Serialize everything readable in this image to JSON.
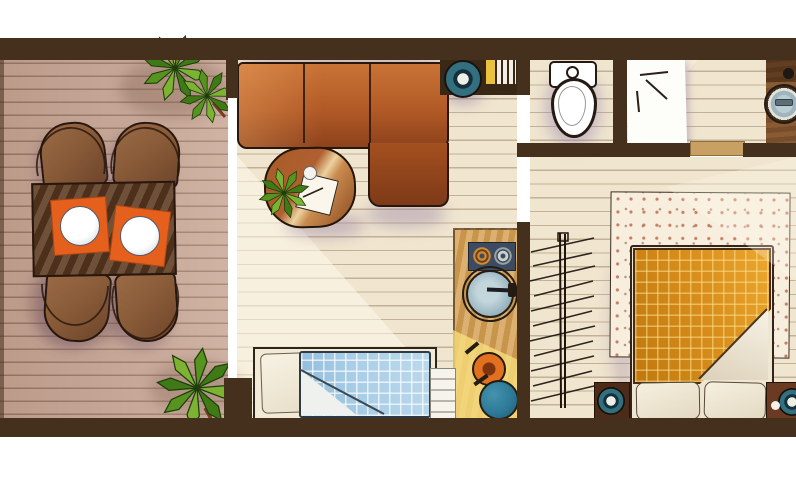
{
  "scene": {
    "type": "floor-plan-illustration",
    "description": "hand-drawn top-down apartment floor plan, no text labels",
    "canvas": {
      "width": 796,
      "height": 480
    }
  },
  "rooms": [
    {
      "id": "terrace",
      "name": "wooden deck terrace",
      "objects": [
        "dining-table",
        "chair x4",
        "orange-placemat x2",
        "white-plate x2",
        "potted-plant x2"
      ]
    },
    {
      "id": "living-room",
      "name": "living room",
      "objects": [
        "corner-sofa",
        "coffee-table",
        "small-plant",
        "cup",
        "magazine",
        "single-bed-blue-plaid",
        "kitchenette-counter",
        "stove-two-burners",
        "round-sink",
        "frying-pan",
        "teal-pot",
        "wall-shelf",
        "teal-speaker",
        "yellow-stripe",
        "white-slats"
      ]
    },
    {
      "id": "bathroom",
      "name": "toilet room",
      "objects": [
        "toilet"
      ]
    },
    {
      "id": "shower-room",
      "name": "shower room",
      "objects": [
        "white-bath-mat",
        "washbasin",
        "wood-counter",
        "knob"
      ]
    },
    {
      "id": "bedroom",
      "name": "bedroom",
      "objects": [
        "double-bed-orange-plaid",
        "folded-blanket-corner",
        "pillow x2",
        "speckled-rug",
        "nightstand x2",
        "teal-speaker x2",
        "drying-rack-sketch"
      ]
    }
  ],
  "colors": {
    "wall": "#452f1d",
    "deck_floor": "#c7a492",
    "room_floor": "#f0e5cf",
    "outline": "#27170e",
    "sofa_light": "#c97336",
    "sofa_mid": "#b25a26",
    "sofa_dark": "#8d421c",
    "chaise_dark": "#7e3a18",
    "coffee_table": "#b06030",
    "table_band": "#ecd2a0",
    "dining_table": "#5f3c22",
    "chair_wood": "#8a5c39",
    "placemat_orange": "#e55f1d",
    "plate_white": "#ffffff",
    "plant_light": "#7cb332",
    "plant_dark": "#3f7a17",
    "stem_brown": "#7a3c20",
    "shelf_brown": "#3a2817",
    "stripe_yellow": "#eac23e",
    "slat_white": "#f2eee6",
    "speaker_teal": "#33707f",
    "speaker_navy": "#14303c",
    "speaker_center": "#eef0e8",
    "stove_navy": "#3c4a62",
    "burner_orange": "#cf8a35",
    "burner_gray": "#cdd3cf",
    "counter_wood": "#d4a156",
    "ksink_gray": "#96b2bd",
    "pan_orange": "#e2701f",
    "pot_teal": "#2b7795",
    "slatbox_white": "#f6f3ec",
    "rack_ink": "#1f150d",
    "mat_white": "#fdfdfa",
    "door_leaf": "#c9a064",
    "nook_wood": "#8a5a33",
    "nook_sink": "#9fb6c0",
    "rug_base": "#f7eede",
    "blanket_orange": "#d88f1d",
    "blanket_fold": "#f8f3e6",
    "sheet_cream": "#efe6d2",
    "pillow_cream": "#f6f0df",
    "nightstand_dark": "#4c2c18",
    "nightstand_red": "#6b3a22",
    "blue_blanket": "#a9cee7",
    "blue_fold": "#eef1ee",
    "bedframe_ink": "#33231a",
    "shadow_purple": "#8e78a0"
  }
}
